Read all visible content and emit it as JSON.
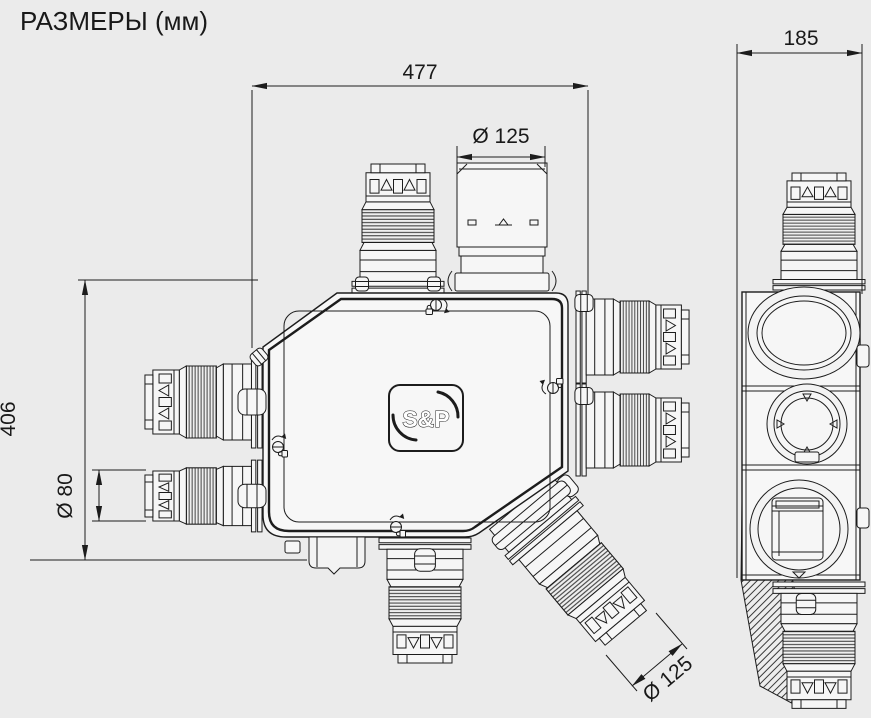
{
  "title": "РАЗМЕРЫ (мм)",
  "colors": {
    "background": "#ebebeb",
    "line": "#1c1c1c",
    "fill": "#f4f4f4"
  },
  "logo": {
    "brand": "S&P"
  },
  "dimensions": {
    "overall_width": "477",
    "overall_height": "406",
    "depth": "185",
    "top_port_diameter": "Ø 125",
    "left_port_diameter": "Ø 80",
    "diagonal_port_diameter": "Ø 125"
  },
  "icons": {
    "screw_lock": "screw-lock-icon",
    "clamp": "flange-clamp"
  }
}
